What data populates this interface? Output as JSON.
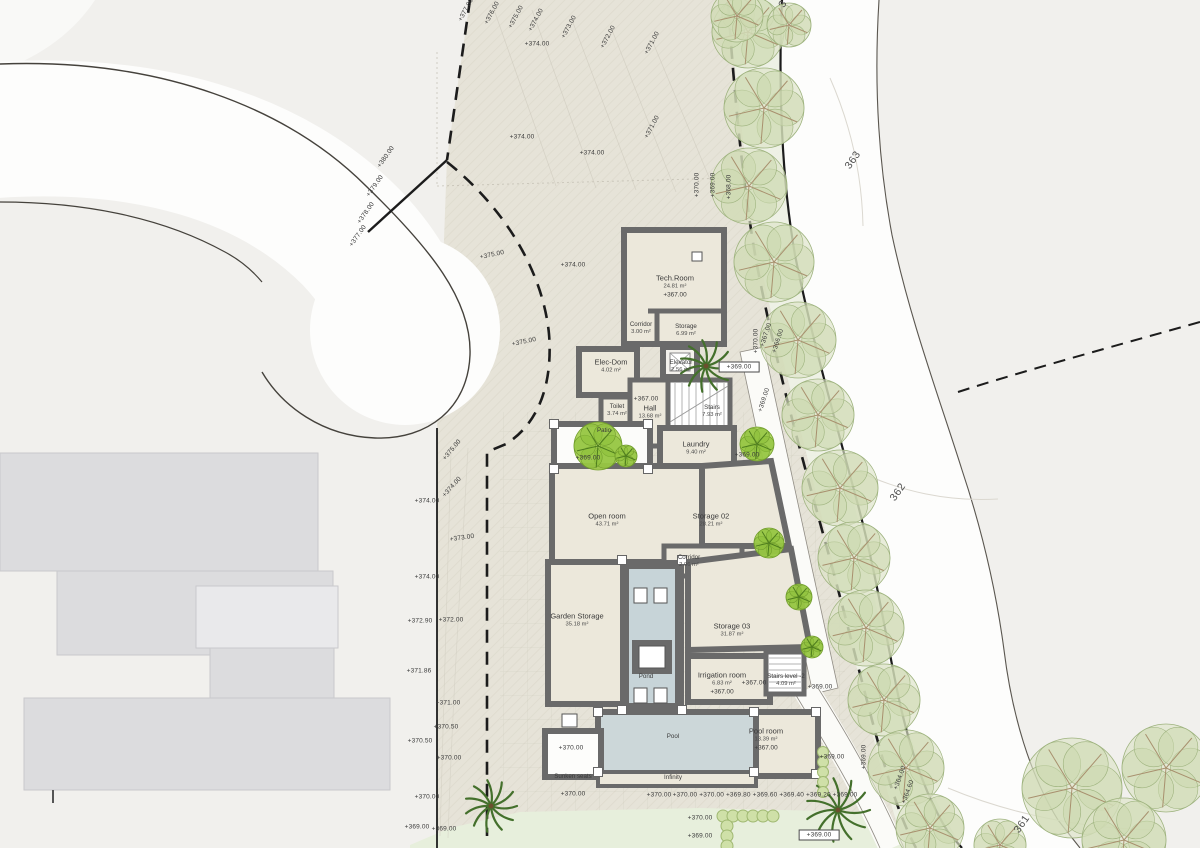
{
  "palette": {
    "plot_fill": "#e6e3d8",
    "outside_fill": "#f1f0ed",
    "road_fill": "#fdfdfc",
    "tree_strip_fill": "#eff3e7",
    "lawn_fill": "#e7efdc",
    "wall_color": "#6a6a6a",
    "floor_fill": "#ece8db",
    "pool_fill": "#ccd7d9",
    "pond_fill": "#c7d4d8",
    "neighbor_building_fill": "#dcdcde",
    "bright_tree_green": "#a5cf4e",
    "olive_tree_green": "#d7e0c2",
    "label_color": "#3b3b3b"
  },
  "rooms": [
    {
      "id": "tech-room",
      "name": "Tech.Room",
      "area": "24.81 m²",
      "elev": "+367.00",
      "x": 675,
      "y": 287
    },
    {
      "id": "corridor-1",
      "name": "Corridor",
      "area": "3.00 m²",
      "x": 641,
      "y": 329,
      "small": true
    },
    {
      "id": "storage-1",
      "name": "Storage",
      "area": "6.99 m²",
      "x": 686,
      "y": 331,
      "small": true
    },
    {
      "id": "elec-dom",
      "name": "Elec-Dom",
      "area": "4.02 m²",
      "x": 611,
      "y": 366
    },
    {
      "id": "elevator",
      "name": "Elevator",
      "area": "2.56 m²",
      "x": 681,
      "y": 367,
      "small": true
    },
    {
      "id": "toilet",
      "name": "Toilet",
      "area": "3.74 m²",
      "x": 617,
      "y": 411,
      "small": true
    },
    {
      "id": "hall",
      "name": "Hall",
      "area": "13.68 m²",
      "x": 650,
      "y": 412
    },
    {
      "id": "stairs",
      "name": "Stairs",
      "area": "7.93 m²",
      "x": 712,
      "y": 412,
      "small": true
    },
    {
      "id": "laundry",
      "name": "Laundry",
      "area": "9.40 m²",
      "x": 696,
      "y": 448
    },
    {
      "id": "patio",
      "name": "Patio",
      "x": 604,
      "y": 431,
      "small": true
    },
    {
      "id": "open-room",
      "name": "Open room",
      "area": "43.71 m²",
      "x": 607,
      "y": 520
    },
    {
      "id": "storage-02",
      "name": "Storage 02",
      "area": "28.21 m²",
      "x": 711,
      "y": 520
    },
    {
      "id": "corridor-2",
      "name": "Corridor",
      "area": "2.96 m²",
      "x": 689,
      "y": 562,
      "small": true
    },
    {
      "id": "garden-storage",
      "name": "Garden Storage",
      "area": "35.18 m²",
      "x": 577,
      "y": 620
    },
    {
      "id": "storage-03",
      "name": "Storage 03",
      "area": "31.87 m²",
      "x": 732,
      "y": 630
    },
    {
      "id": "pond",
      "name": "Pond",
      "x": 646,
      "y": 677,
      "small": true
    },
    {
      "id": "irrigation-room",
      "name": "Irrigation room",
      "area": "6.83 m²",
      "elev": "+367.00",
      "x": 722,
      "y": 684
    },
    {
      "id": "stairs-level-2",
      "name": "Stairs level -2",
      "area": "4.09 m²",
      "x": 786,
      "y": 681,
      "small": true
    },
    {
      "id": "pool",
      "name": "Pool",
      "x": 673,
      "y": 737,
      "small": true
    },
    {
      "id": "pool-room",
      "name": "Pool room",
      "area": "13.39 m²",
      "elev": "+367.00",
      "x": 766,
      "y": 740
    },
    {
      "id": "sunken-seats",
      "name": "Sunken seats",
      "x": 573,
      "y": 777,
      "small": true
    },
    {
      "id": "infinity",
      "name": "Infinity",
      "x": 673,
      "y": 778,
      "small": true
    }
  ],
  "elevation_labels": [
    {
      "t": "+377.00",
      "x": 466,
      "y": 10,
      "r": -62
    },
    {
      "t": "+376.00",
      "x": 492,
      "y": 13,
      "r": -62
    },
    {
      "t": "+375.00",
      "x": 516,
      "y": 17,
      "r": -62
    },
    {
      "t": "+374.00",
      "x": 536,
      "y": 20,
      "r": -62
    },
    {
      "t": "+373.00",
      "x": 569,
      "y": 27,
      "r": -62
    },
    {
      "t": "+372.00",
      "x": 608,
      "y": 37,
      "r": -62
    },
    {
      "t": "+371.00",
      "x": 652,
      "y": 43,
      "r": -62
    },
    {
      "t": "+374.00",
      "x": 537,
      "y": 44,
      "r": 0
    },
    {
      "t": "+374.00",
      "x": 522,
      "y": 137,
      "r": 0
    },
    {
      "t": "+371.00",
      "x": 652,
      "y": 127,
      "r": -62
    },
    {
      "t": "+374.00",
      "x": 592,
      "y": 153,
      "r": 0
    },
    {
      "t": "+380.00",
      "x": 386,
      "y": 157,
      "r": -55
    },
    {
      "t": "+379.00",
      "x": 375,
      "y": 186,
      "r": -55
    },
    {
      "t": "+378.00",
      "x": 366,
      "y": 213,
      "r": -55
    },
    {
      "t": "+377.00",
      "x": 358,
      "y": 236,
      "r": -55
    },
    {
      "t": "+375.00",
      "x": 492,
      "y": 255,
      "r": -12
    },
    {
      "t": "+374.00",
      "x": 573,
      "y": 265,
      "r": 0
    },
    {
      "t": "+375.00",
      "x": 524,
      "y": 342,
      "r": -12
    },
    {
      "t": "+370.00",
      "x": 697,
      "y": 185,
      "r": -90
    },
    {
      "t": "+369.00",
      "x": 713,
      "y": 185,
      "r": -90
    },
    {
      "t": "+368.00",
      "x": 729,
      "y": 187,
      "r": -90
    },
    {
      "t": "+375.00",
      "x": 452,
      "y": 450,
      "r": -50
    },
    {
      "t": "+374.00",
      "x": 452,
      "y": 487,
      "r": -48
    },
    {
      "t": "+374.00",
      "x": 427,
      "y": 501,
      "r": 0
    },
    {
      "t": "+373.00",
      "x": 462,
      "y": 538,
      "r": -8
    },
    {
      "t": "+374.00",
      "x": 427,
      "y": 577,
      "r": 0
    },
    {
      "t": "+372.90",
      "x": 420,
      "y": 621,
      "r": 0
    },
    {
      "t": "+372.00",
      "x": 451,
      "y": 620,
      "r": 0
    },
    {
      "t": "+371.86",
      "x": 419,
      "y": 671,
      "r": 0
    },
    {
      "t": "+371.00",
      "x": 448,
      "y": 703,
      "r": 0
    },
    {
      "t": "+370.50",
      "x": 446,
      "y": 727,
      "r": 0
    },
    {
      "t": "+370.50",
      "x": 420,
      "y": 741,
      "r": 0
    },
    {
      "t": "+370.00",
      "x": 449,
      "y": 758,
      "r": 0
    },
    {
      "t": "+370.00",
      "x": 427,
      "y": 797,
      "r": 0
    },
    {
      "t": "+369.00",
      "x": 417,
      "y": 827,
      "r": 0
    },
    {
      "t": "+369.00",
      "x": 444,
      "y": 829,
      "r": 0
    },
    {
      "t": "+370.00",
      "x": 756,
      "y": 341,
      "r": -90
    },
    {
      "t": "+367.00",
      "x": 766,
      "y": 335,
      "r": -72
    },
    {
      "t": "+366.00",
      "x": 778,
      "y": 341,
      "r": -72
    },
    {
      "t": "+369.00",
      "x": 739,
      "y": 367,
      "r": 0,
      "box": true
    },
    {
      "t": "+369.00",
      "x": 764,
      "y": 400,
      "r": -72
    },
    {
      "t": "+369.00",
      "x": 588,
      "y": 458,
      "r": 0
    },
    {
      "t": "+369.00",
      "x": 747,
      "y": 455,
      "r": 0
    },
    {
      "t": "+367.00",
      "x": 646,
      "y": 399,
      "r": 0
    },
    {
      "t": "+367.00",
      "x": 754,
      "y": 683,
      "r": 0
    },
    {
      "t": "+369.00",
      "x": 820,
      "y": 687,
      "r": 0
    },
    {
      "t": "+369.00",
      "x": 832,
      "y": 757,
      "r": 0
    },
    {
      "t": "+369.00",
      "x": 864,
      "y": 757,
      "r": -90
    },
    {
      "t": "+364.00",
      "x": 900,
      "y": 778,
      "r": -70
    },
    {
      "t": "+364.60",
      "x": 908,
      "y": 792,
      "r": -70
    },
    {
      "t": "+370.00",
      "x": 571,
      "y": 748,
      "r": 0
    },
    {
      "t": "+370.00",
      "x": 573,
      "y": 794,
      "r": 0
    },
    {
      "t": "+370.00",
      "x": 659,
      "y": 795,
      "r": 0
    },
    {
      "t": "+370.00 +370.00 +369.80 +369.60 +369.40 +369.20 +369.00",
      "x": 765,
      "y": 795,
      "r": 0
    },
    {
      "t": "+370.00",
      "x": 700,
      "y": 818,
      "r": 0
    },
    {
      "t": "+369.00",
      "x": 700,
      "y": 836,
      "r": 0
    },
    {
      "t": "+369.00",
      "x": 819,
      "y": 835,
      "r": 0,
      "box": true
    }
  ],
  "road_contour_labels": [
    {
      "t": "363",
      "x": 853,
      "y": 160,
      "r": -55
    },
    {
      "t": "362",
      "x": 898,
      "y": 492,
      "r": -55
    },
    {
      "t": "361",
      "x": 1022,
      "y": 824,
      "r": -55
    },
    {
      "t": "3",
      "x": 783,
      "y": 4,
      "r": -60
    }
  ]
}
